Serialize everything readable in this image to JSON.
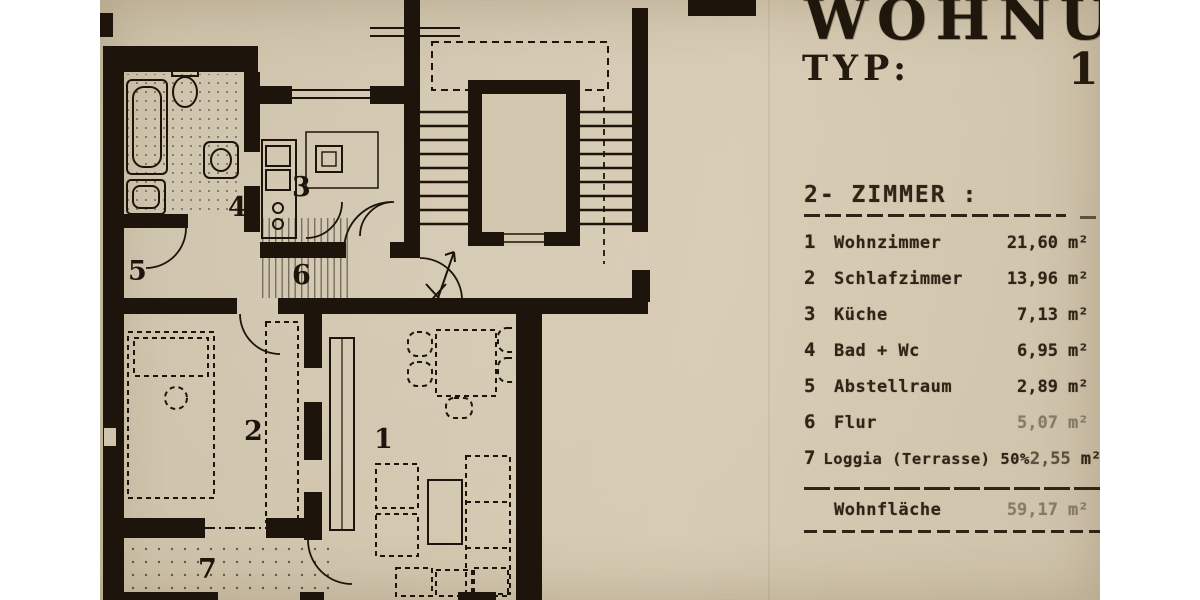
{
  "photo": {
    "paper_color": "#d2c6ae",
    "ink_color": "#1d150b"
  },
  "header": {
    "title": "WOHNUNG",
    "type_label": "TYP:",
    "type_value": "1B"
  },
  "apartment": {
    "heading": "2- ZIMMER :",
    "rows": [
      {
        "num": "1",
        "name": "Wohnzimmer",
        "value": "21,60",
        "unit": "m²"
      },
      {
        "num": "2",
        "name": "Schlafzimmer",
        "value": "13,96",
        "unit": "m²"
      },
      {
        "num": "3",
        "name": "Küche",
        "value": "7,13",
        "unit": "m²"
      },
      {
        "num": "4",
        "name": "Bad + Wc",
        "value": "6,95",
        "unit": "m²"
      },
      {
        "num": "5",
        "name": "Abstellraum",
        "value": "2,89",
        "unit": "m²"
      },
      {
        "num": "6",
        "name": "Flur",
        "value": "5,07",
        "unit": "m²"
      },
      {
        "num": "7",
        "name": "Loggia (Terrasse) 50%",
        "value": "2,55",
        "unit": "m²"
      }
    ],
    "total": {
      "name": "Wohnfläche",
      "value": "59,17",
      "unit": "m²"
    }
  },
  "plan": {
    "room_labels": [
      "1",
      "2",
      "3",
      "4",
      "5",
      "6",
      "7"
    ]
  }
}
